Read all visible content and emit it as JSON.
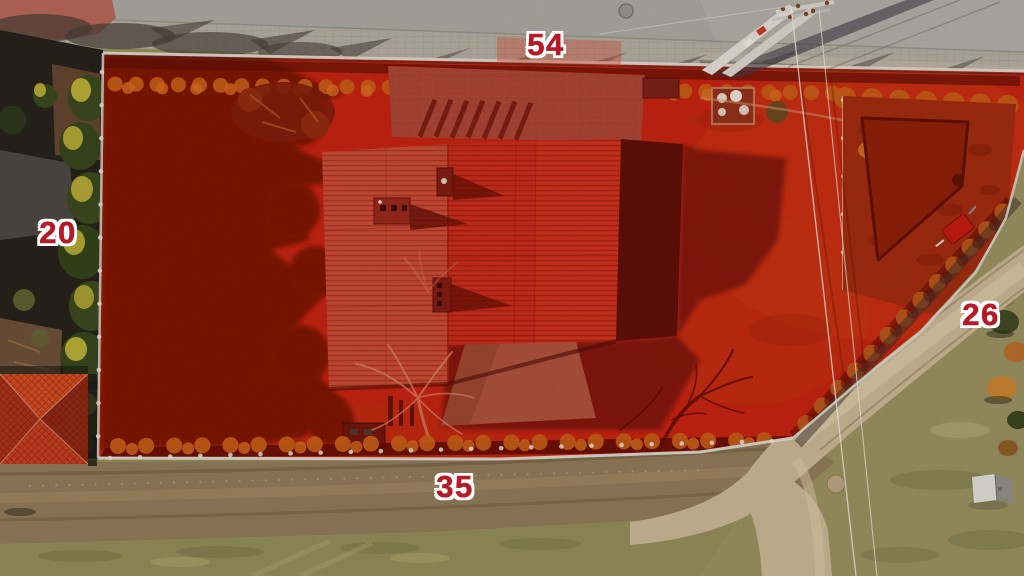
{
  "labels": {
    "top": "54",
    "left": "20",
    "right": "26",
    "bottom": "35"
  },
  "colors": {
    "overlay_red": "#bf2310",
    "overlay_red_dark": "#7a1306",
    "label_fill": "#b51b26",
    "label_outline": "#ffffff",
    "road": "#a7a39c",
    "sidewalk": "#aea89b",
    "dirt_road": "#8d7657",
    "grass_field": "#8e8956",
    "gravel_road": "#c3b190",
    "house_roof": "#c02817",
    "neighbor_roof": "#cf4a20"
  }
}
